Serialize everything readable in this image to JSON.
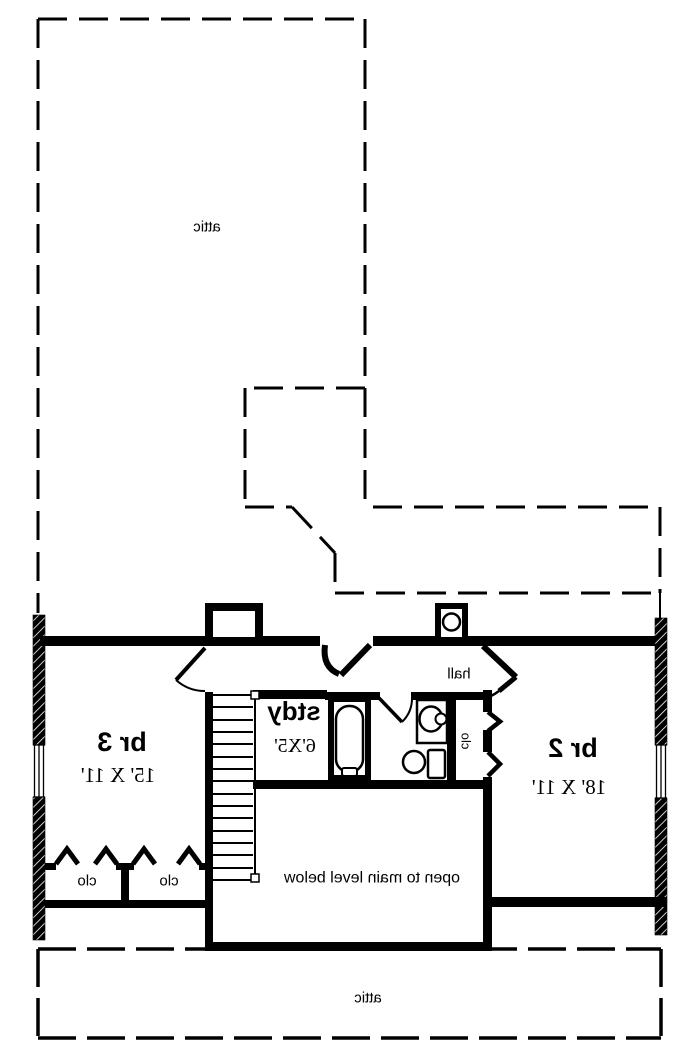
{
  "plan": {
    "attic_top_label": "attic",
    "attic_bottom_label": "attic",
    "open_label": "open to main level below",
    "hall_label": "hall",
    "rooms": [
      {
        "name": "br 3",
        "dims": "15' X 11'"
      },
      {
        "name": "stdy",
        "dims": "6'X5'"
      },
      {
        "name": "br 2",
        "dims": "18' X 11'"
      }
    ],
    "closet_labels": [
      "clo",
      "clo",
      "clo"
    ],
    "colors": {
      "line": "#000000",
      "background": "#ffffff"
    }
  }
}
